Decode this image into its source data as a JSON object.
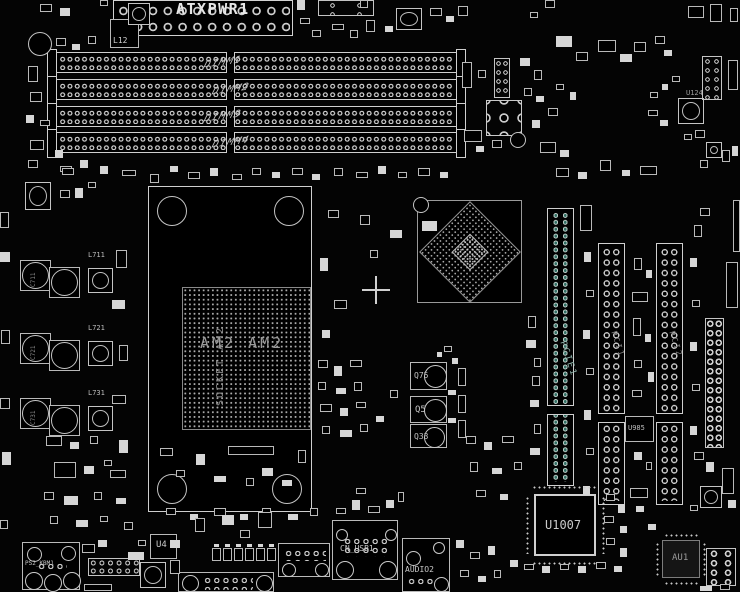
{
  "colors": {
    "background": "#000000",
    "silkscreen": "#d6d6d6",
    "dim_text": "#8f8f8f",
    "pcie_teal": "#2f6e63"
  },
  "labels": {
    "atxpwr1": "ATXPWR1",
    "l12": "L12",
    "dimm_slots": [
      "DIMM1",
      "DIMM2",
      "DIMM3",
      "DIMM4"
    ],
    "u124": "U124",
    "socket_vertical": "SOCKET AM2",
    "socket_horizontal": "AM2 AM2",
    "vrm_inductors": [
      "L711",
      "L721",
      "L731"
    ],
    "vrm_caps": [
      "C711",
      "C721",
      "C731"
    ],
    "q75": "Q75",
    "q5": "Q5",
    "q33": "Q33",
    "pcie1": "PCIE1",
    "pci1": "PCI1",
    "pci2": "PCI2",
    "u985": "U985",
    "u1007": "U1007",
    "au1": "AU1",
    "u4": "U4",
    "ps2": "PS2_KBM1",
    "usb": "CN_USB1",
    "audio": "AUDIO2"
  }
}
